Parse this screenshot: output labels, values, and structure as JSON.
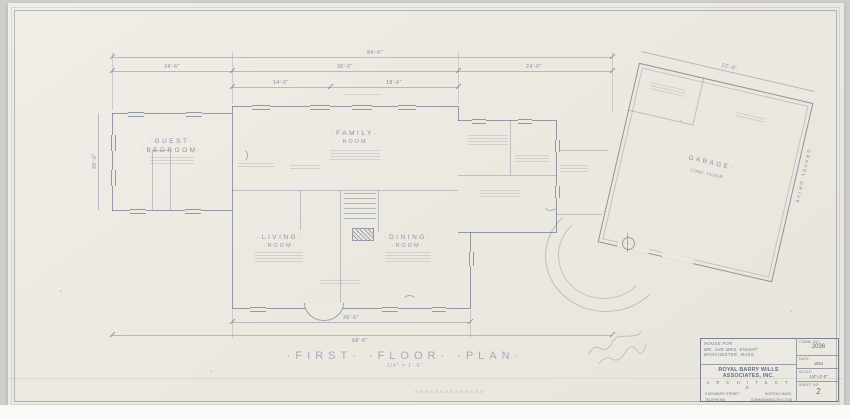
{
  "titles": {
    "main": "·FIRST·  ·FLOOR·  ·PLAN·",
    "scale": "·1/4\" = 1'-0\"·"
  },
  "dims": {
    "top_overall": "84'-6\"",
    "top_left": "24'-6\"",
    "top_center": "36'-0\"",
    "top_right": "24'-0\"",
    "sub_left": "14'-0\"",
    "sub_right": "18'-6\"",
    "left_side": "26'-0\"",
    "bottom_inner": "36'-6\"",
    "bottom_overall": "68'-6\"",
    "garage_top": "22'-0\""
  },
  "rooms": {
    "guest_l1": "·GUEST·",
    "guest_l2": "·BEDROOM·",
    "family_l1": "·FAMILY·",
    "family_l2": "·ROOM·",
    "living_l1": "·LIVING·",
    "living_l2": "·ROOM·",
    "dining_l1": "·DINING·",
    "dining_l2": "·ROOM·",
    "garage": "·GARAGE·",
    "garage_note": "CONC. FLOOR",
    "drive_note": "GRAVEL DRIVE"
  },
  "titleblock": {
    "project_line1": "HOUSE FOR",
    "project_line2": "MR. AND MRS. KNIGHT",
    "project_line3": "MANCHESTER, MASS.",
    "firm": "ROYAL BARRY WILLS ASSOCIATES, INC.",
    "firm_sub": "A R C H I T E C T S",
    "addr1a": "8 NEWBURY STREET",
    "addr1b": "BOSTON, MASS.",
    "addr2a": "TELEPHONE",
    "addr2b": "COMMONWEALTH 6-2748",
    "comm_label": "COMM. NO.",
    "comm_value": "2036",
    "date_label": "DATE",
    "date_value": "1954",
    "scale_label": "SCALE",
    "scale_value": "1/4\"=1'-0\"",
    "sheet_label": "SHEET NO.",
    "sheet_value": "2"
  }
}
